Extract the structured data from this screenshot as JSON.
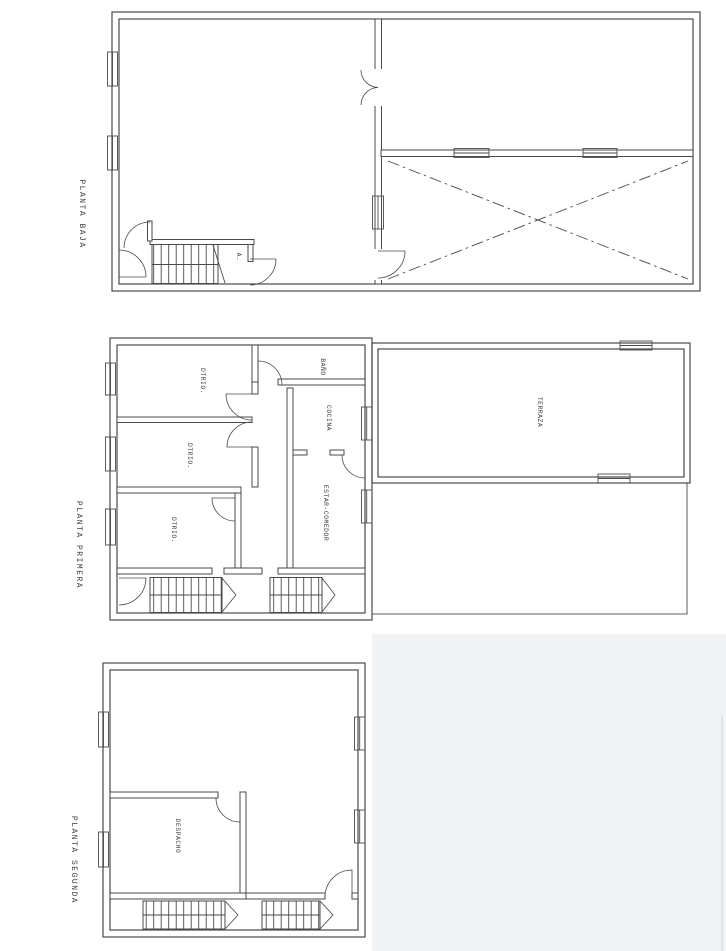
{
  "drawing": {
    "colors": {
      "ink": "#4a4a4a",
      "paper": "#ffffff",
      "scan_shadow": "#f2f3f5"
    },
    "plans": [
      {
        "title": "PLANTA BAJA",
        "rooms": [
          {
            "label": "A."
          }
        ]
      },
      {
        "title": "PLANTA PRIMERA",
        "rooms": [
          {
            "label": "DTRIO."
          },
          {
            "label": "DTRIO."
          },
          {
            "label": "DTRIO."
          },
          {
            "label": "BAÑO"
          },
          {
            "label": "COCINA"
          },
          {
            "label": "ESTAR-COMEDOR"
          },
          {
            "label": "TERRAZA"
          }
        ]
      },
      {
        "title": "PLANTA SEGUNDA",
        "rooms": [
          {
            "label": "DESPACHO"
          }
        ]
      }
    ]
  }
}
